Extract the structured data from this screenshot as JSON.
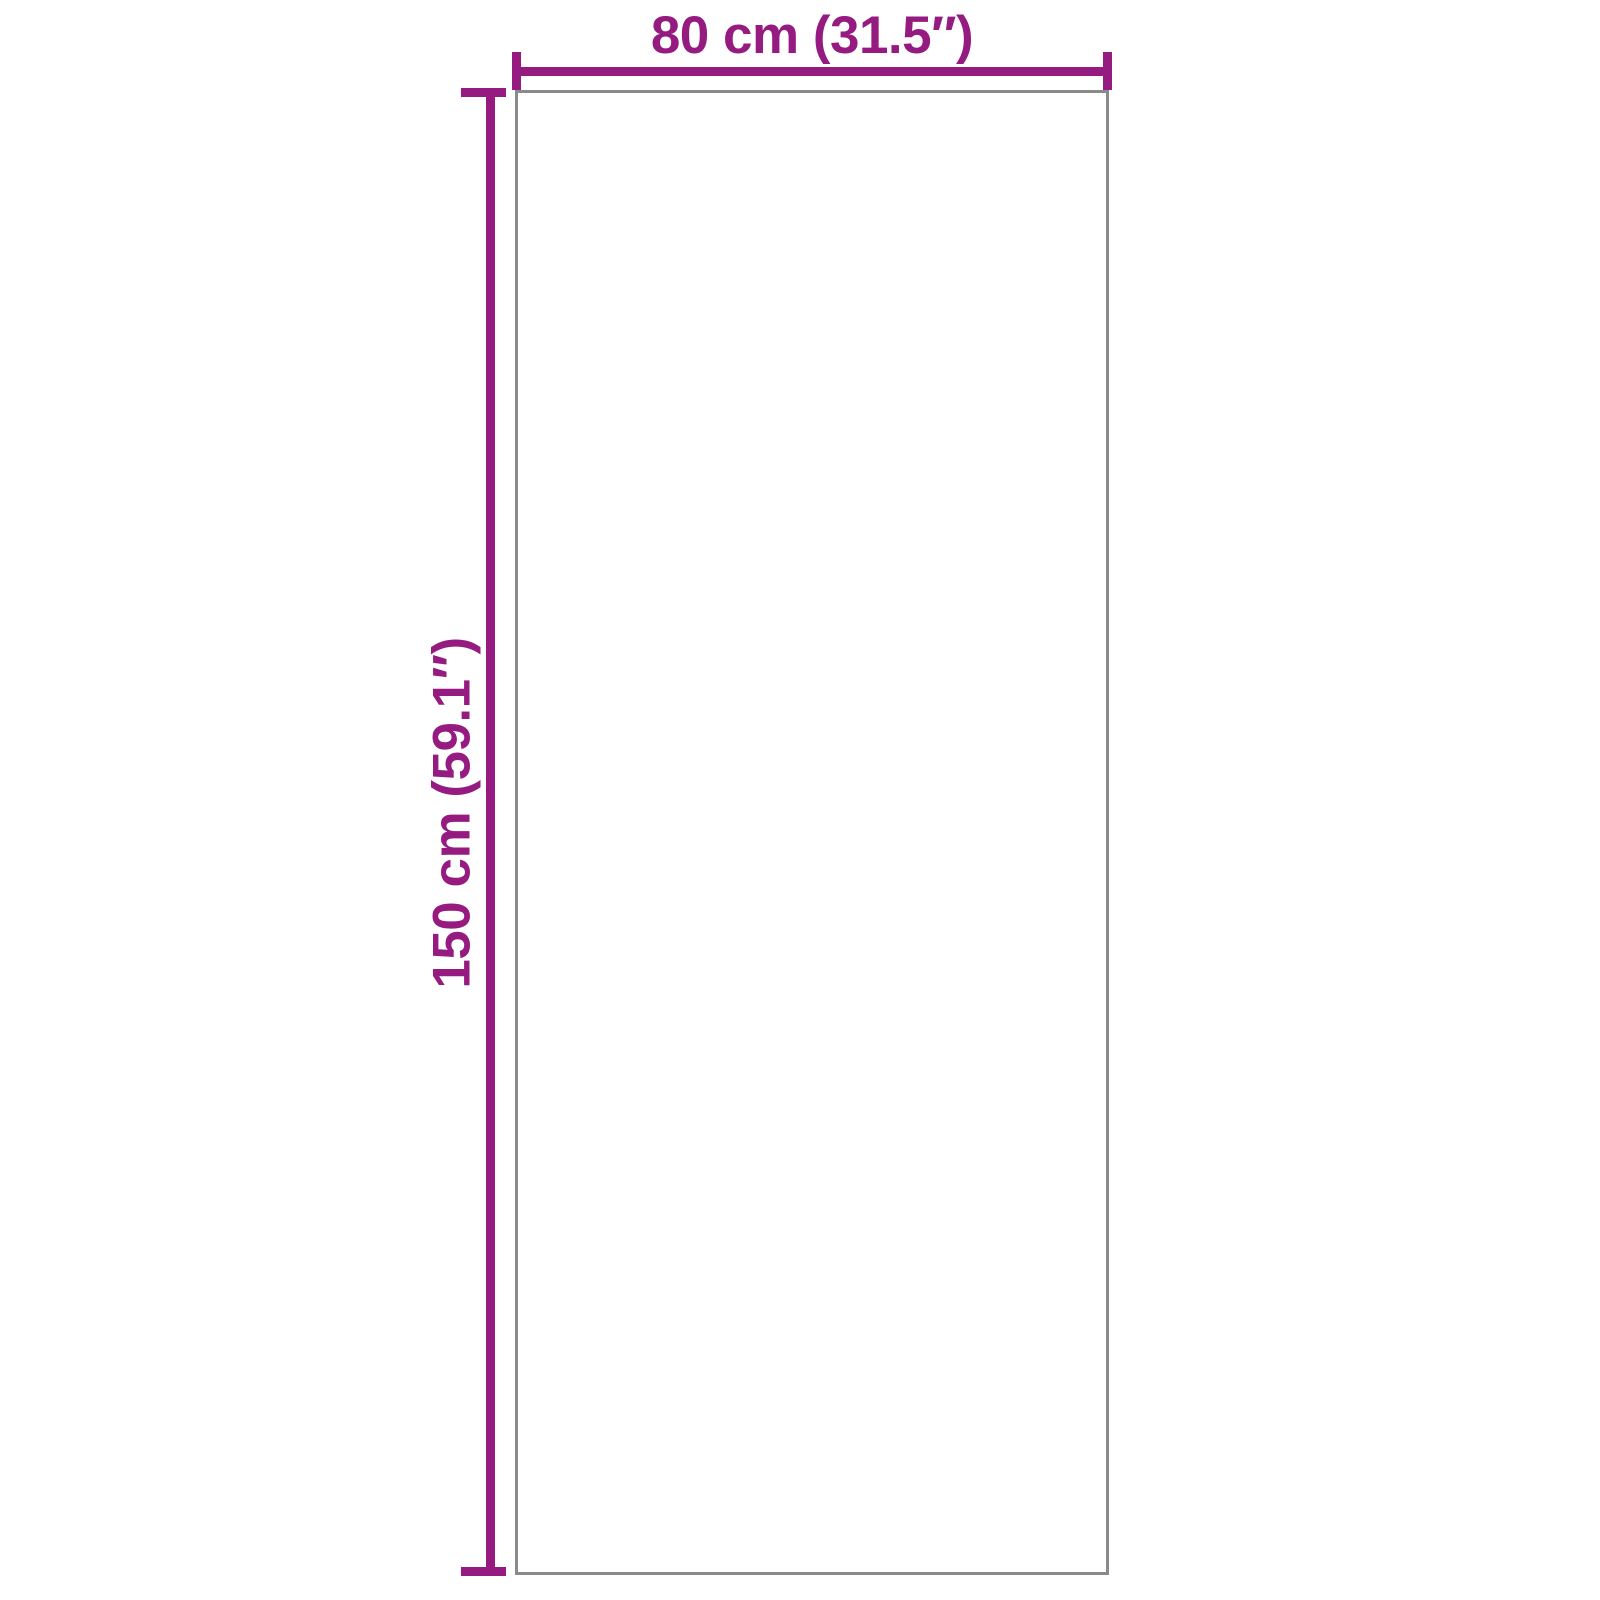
{
  "diagram": {
    "kind": "product-dimension-diagram",
    "dimensions": {
      "width": {
        "label": "80 cm (31.5″)",
        "cm": "80 cm",
        "inches": "31.5″"
      },
      "height": {
        "label": "150 cm (59.1″)",
        "cm": "150 cm",
        "inches": "59.1″"
      }
    }
  },
  "colors": {
    "accent": "#951B81",
    "outline": "#8A8A8A",
    "background": "#FFFFFF"
  }
}
